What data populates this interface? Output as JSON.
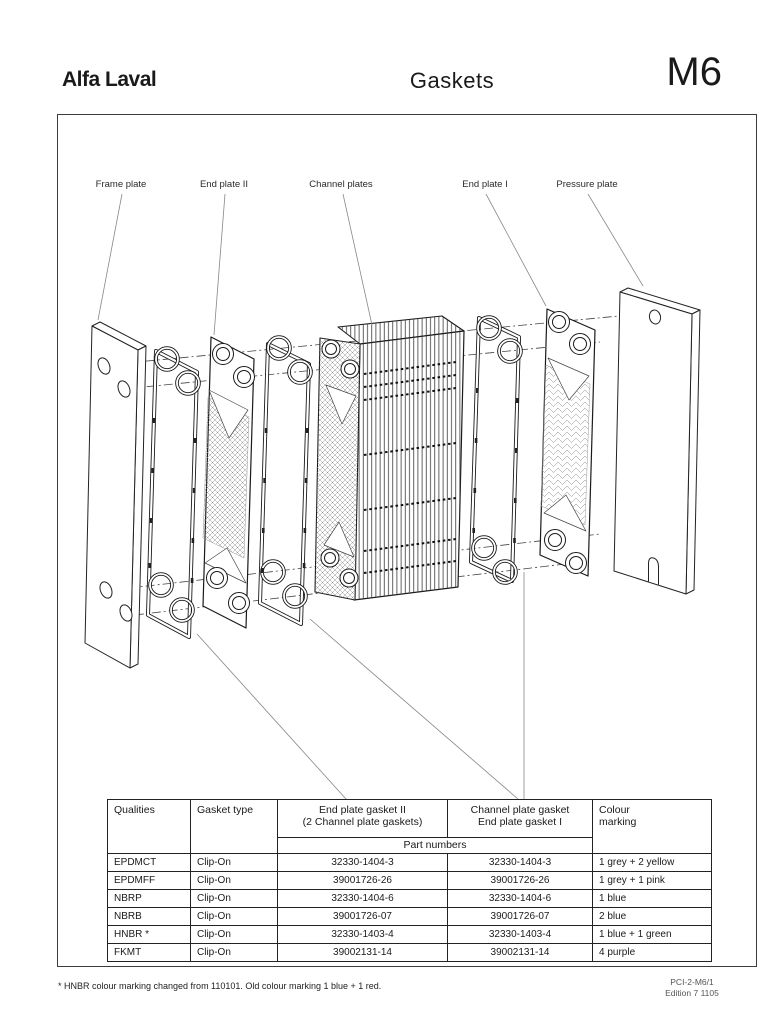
{
  "header": {
    "brand": "Alfa Laval",
    "title": "Gaskets",
    "model": "M6"
  },
  "diagram": {
    "labels": {
      "frame_plate": "Frame plate",
      "end_plate_ii": "End plate II",
      "channel_plates": "Channel plates",
      "end_plate_i": "End plate I",
      "pressure_plate": "Pressure plate"
    }
  },
  "table": {
    "headers": {
      "qualities": "Qualities",
      "gasket_type": "Gasket type",
      "col3_line1": "End plate  gasket II",
      "col3_line2": "(2 Channel plate gaskets)",
      "col4_line1": "Channel plate gasket",
      "col4_line2": "End plate gasket I",
      "colour_line1": "Colour",
      "colour_line2": "marking",
      "part_numbers": "Part numbers"
    },
    "rows": [
      {
        "quality": "EPDMCT",
        "type": "Clip-On",
        "part_ii": "32330-1404-3",
        "part_i": "32330-1404-3",
        "colour": "1 grey + 2 yellow"
      },
      {
        "quality": "EPDMFF",
        "type": "Clip-On",
        "part_ii": "39001726-26",
        "part_i": "39001726-26",
        "colour": "1 grey + 1 pink"
      },
      {
        "quality": "NBRP",
        "type": "Clip-On",
        "part_ii": "32330-1404-6",
        "part_i": "32330-1404-6",
        "colour": "1 blue"
      },
      {
        "quality": "NBRB",
        "type": "Clip-On",
        "part_ii": "39001726-07",
        "part_i": "39001726-07",
        "colour": "2 blue"
      },
      {
        "quality": "HNBR *",
        "type": "Clip-On",
        "part_ii": "32330-1403-4",
        "part_i": "32330-1403-4",
        "colour": "1 blue + 1 green"
      },
      {
        "quality": "FKMT",
        "type": "Clip-On",
        "part_ii": "39002131-14",
        "part_i": "39002131-14",
        "colour": "4 purple"
      }
    ]
  },
  "footer": {
    "footnote": "* HNBR colour marking changed from 110101. Old colour marking 1 blue + 1 red.",
    "doc_ref": "PCI-2-M6/1",
    "edition": "Edition 7 1105"
  },
  "colors": {
    "paper": "#ffffff",
    "ink": "#1a1a1a"
  }
}
